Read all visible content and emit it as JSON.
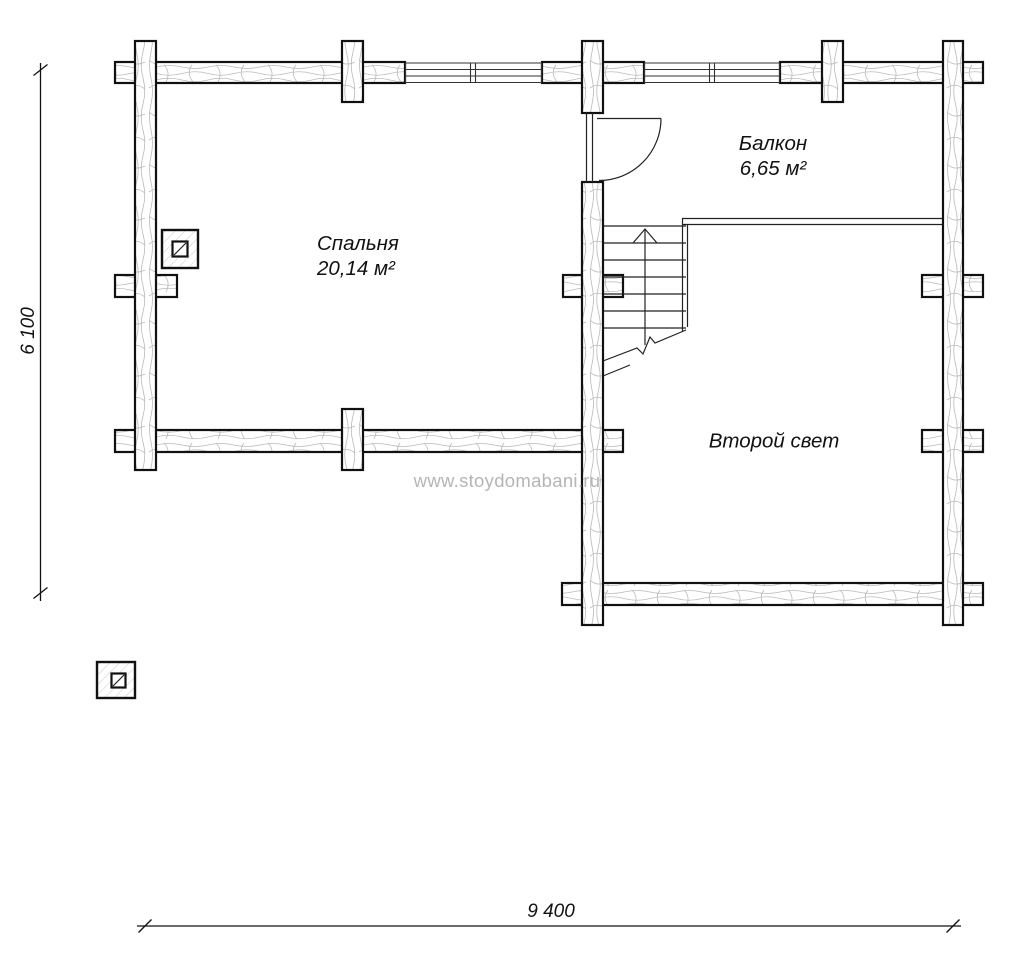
{
  "rooms": {
    "bedroom": {
      "name": "Спальня",
      "area": "20,14 м²"
    },
    "balcony": {
      "name": "Балкон",
      "area": "6,65 м²"
    },
    "second_light": {
      "name": "Второй свет"
    }
  },
  "dimensions": {
    "overall_width": "9 400",
    "overall_depth": "6 100"
  },
  "watermark": "www.stoydomabani.ru",
  "colors": {
    "line": "#111111",
    "wood_grain": "#b9b9b9",
    "column_hatch": "#c9c9c9",
    "watermark_gray": "#b5b5b5",
    "background": "#ffffff"
  },
  "symbols": {
    "stairs_direction_icon": "up-arrow",
    "door_icon": "quarter-circle-door-swing",
    "wall_joint_icon": "log-cross",
    "column_icon": "square-post"
  }
}
